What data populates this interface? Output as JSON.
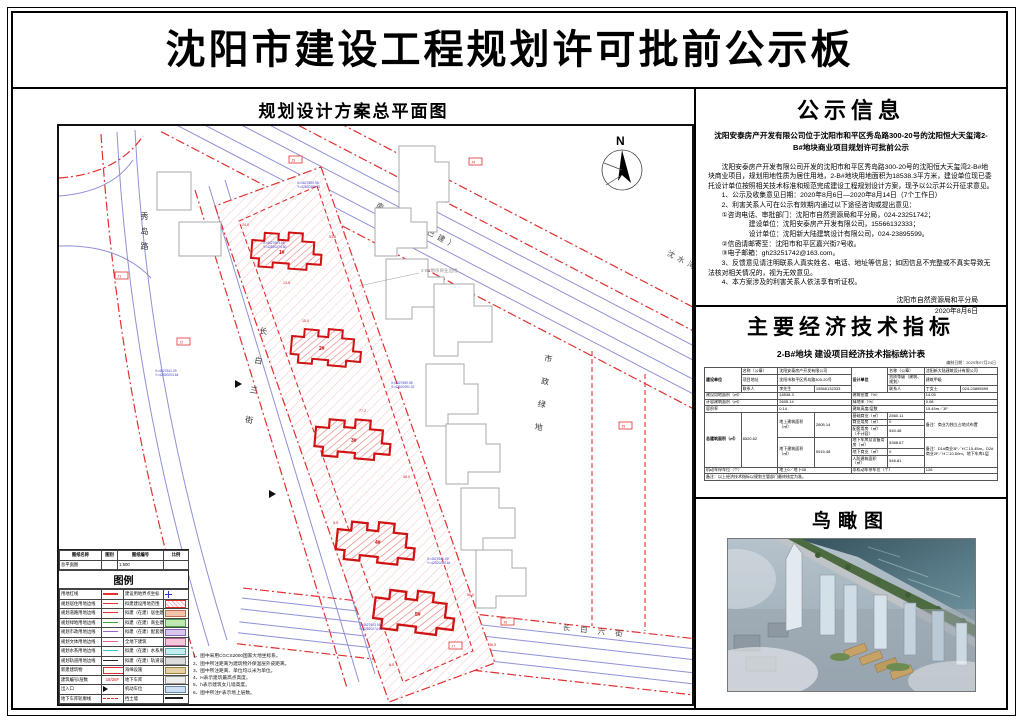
{
  "page": {
    "title": "沈阳市建设工程规划许可批前公示板"
  },
  "plan": {
    "title": "规划设计方案总平面图",
    "north": "N",
    "roads": {
      "xiudao": "秀岛路",
      "changbai3": "长白三街",
      "nandixi": "南堤西路（已建）",
      "shenshuiwan": "沈水湾路",
      "changbai6": "长 白 六 街",
      "green": "市政绿地"
    },
    "site_note": "2-B#地块商业边线",
    "buildings": [
      {
        "id": "1#"
      },
      {
        "id": "2#"
      },
      {
        "id": "3#"
      },
      {
        "id": "4#"
      },
      {
        "id": "5#"
      }
    ],
    "dims": [
      "24.0",
      "53.6",
      "13.5",
      "15.0",
      "77.2",
      "48.0",
      "9.9",
      "56.0",
      "6.0",
      "36.5"
    ],
    "coords": [
      [
        "X=4627659.98",
        "Y=42520391.02"
      ],
      [
        "X=4627603.06",
        "Y=42520274.80"
      ],
      [
        "X=4627641.09",
        "Y=42520203.64"
      ]
    ],
    "markers": [
      "J1",
      "J2",
      "J3",
      "J4",
      "J5",
      "J6",
      "J7",
      "J8"
    ],
    "legend": {
      "title": "图例",
      "head": [
        [
          {
            "t": "图纸名称",
            "cls": "b"
          },
          {
            "t": "图别",
            "cls": "b"
          },
          {
            "t": "图纸编号",
            "cls": "b"
          },
          {
            "t": "比例",
            "cls": "b"
          }
        ],
        [
          {
            "t": "总平面图"
          },
          {
            "t": ""
          },
          {
            "t": "1:500"
          },
          {
            "t": ""
          }
        ]
      ],
      "rows": [
        [
          {
            "t": "用地红线"
          },
          {
            "sym": "line-red"
          },
          {
            "t": "建设用地界点坐标"
          },
          {
            "sym": "coord"
          }
        ],
        [
          {
            "t": "规划居住用地边线"
          },
          {
            "sym": "line-red2"
          },
          {
            "t": "拟建建设用地范围"
          },
          {
            "sym": "box-redhatch"
          }
        ],
        [
          {
            "t": "规划道路用地边线"
          },
          {
            "sym": "line-red2"
          },
          {
            "t": "拟建（在建）居住建筑"
          },
          {
            "sym": "box-peach"
          }
        ],
        [
          {
            "t": "规划绿地用地边线"
          },
          {
            "sym": "line-green"
          },
          {
            "t": "拟建（在建）商业建筑"
          },
          {
            "sym": "box-green"
          }
        ],
        [
          {
            "t": "规划市政用地边线"
          },
          {
            "sym": "line-purple"
          },
          {
            "t": "拟建（在建）配套建筑"
          },
          {
            "sym": "box-purple"
          }
        ],
        [
          {
            "t": "规划文体用地边线"
          },
          {
            "sym": "line-pink"
          },
          {
            "t": "全地下建筑"
          },
          {
            "sym": "box-pink"
          }
        ],
        [
          {
            "t": "规划水系用地边线"
          },
          {
            "sym": "line-cyan"
          },
          {
            "t": "拟建（在建）水系用地"
          },
          {
            "sym": "box-cyan"
          }
        ],
        [
          {
            "t": "规划轨道用地边线"
          },
          {
            "sym": "line-black"
          },
          {
            "t": "拟建（在建）轨道设施"
          },
          {
            "sym": "box-gray"
          }
        ],
        [
          {
            "t": "新建建筑物"
          },
          {
            "sym": "box-redline"
          },
          {
            "t": "海绵设施"
          },
          {
            "sym": "box-tan"
          }
        ],
        [
          {
            "t": "建筑编号/层数"
          },
          {
            "t": "18/26F",
            "cls": "redt"
          },
          {
            "t": "地下车库"
          },
          {
            "sym": "box-lgray"
          }
        ],
        [
          {
            "t": "出入口"
          },
          {
            "sym": "arrowg"
          },
          {
            "t": "机动车位"
          },
          {
            "sym": "box-blue"
          }
        ],
        [
          {
            "t": "地下车库轮廓线"
          },
          {
            "sym": "dash-red"
          },
          {
            "t": "挡土墙"
          },
          {
            "sym": "line-black2"
          }
        ]
      ],
      "notes": [
        "1、图中采用CGCS2000国家大地坐标系。",
        "2、图中所注距离为建筑物外保温层外皮距离。",
        "3、图中所注距离、单位均以米为单位。",
        "4、H表示建筑最高点高度。",
        "5、h表示建筑女儿墙高度。",
        "6、图中所注F表示地上层数。"
      ]
    }
  },
  "notice": {
    "title": "公示信息",
    "subtitle": "沈阳安泰房产开发有限公司位于沈阳市和平区秀岛路300-20号的沈阳恒大天玺湾2-B#地块商业项目规划许可批前公示",
    "paragraphs": [
      "　　沈阳安泰房产开发有限公司开发的沈阳市和平区秀岛路300-20号的沈阳恒大天玺湾2-B#地块商业项目，规划用地性质为居住用地，2-B#地块用地面积为18538.3平方米，建设单位现已委托设计单位按照相关技术标准和规范完成建设工程规划设计方案，现予以公示并公开征求意见。",
      "　　1、公示及收集意见日期：2020年8月6日—2020年8月14日（7个工作日）",
      "　　2、利害关系人可在公示有效期内通过以下途径咨询或提出意见：",
      "　　①咨询电话、审批部门：沈阳市自然资源局和平分局，024-23251742；",
      "　　　　　　建设单位：沈阳安泰房产开发有限公司，15566132333；",
      "　　　　　　设计单位：沈阳新大陆建筑设计有限公司，024-23895599。",
      "　　②信函请邮寄至：沈阳市和平区嘉兴街7号收。",
      "　　③电子邮箱：gh23251742@163.com。",
      "　　3、反馈意见请注明联系人真实姓名、电话、地址等信息；如因信息不完整或不真实导致无法核对相关情况的，视为无效意见。",
      "　　4、本方案涉及的利害关系人依法享有听证权。"
    ],
    "sign1": "沈阳市自然资源局和平分局",
    "sign2": "2020年8月6日"
  },
  "indicators": {
    "title": "主要经济技术指标",
    "table_title": "2-B#地块 建设项目经济技术指标统计表",
    "table_date": "编制日期：2020年07月24日",
    "grid": [
      [
        {
          "t": "建设单位",
          "r": 3,
          "cls": "b"
        },
        {
          "t": "名称（公章）"
        },
        {
          "t": "沈阳安泰房产开发有限公司",
          "c": 2
        },
        {
          "t": "设计单位",
          "r": 3,
          "cls": "b"
        },
        {
          "t": "名称（公章）"
        },
        {
          "t": "沈阳新大陆建筑设计有限公司",
          "c": 2
        }
      ],
      [
        {
          "t": "项目地址"
        },
        {
          "t": "沈阳市和平区秀岛路300-20号",
          "c": 2
        },
        {
          "t": "资质等级（建筑、规划）"
        },
        {
          "t": "建筑甲级",
          "c": 2
        }
      ],
      [
        {
          "t": "联系人"
        },
        {
          "t": "李先生"
        },
        {
          "t": "15566132333"
        },
        {
          "t": "联系人"
        },
        {
          "t": "丁女士"
        },
        {
          "t": "024-23895599"
        }
      ],
      [
        {
          "t": "建设用地面积（㎡）",
          "c": 2
        },
        {
          "t": "18538.3",
          "c": 2
        },
        {
          "t": "建筑密度（%）",
          "c": 2
        },
        {
          "t": "14.05",
          "c": 2
        }
      ],
      [
        {
          "t": "计容建筑面积（㎡）",
          "c": 2
        },
        {
          "t": "2605.14",
          "c": 2
        },
        {
          "t": "绿地率（%）",
          "c": 2
        },
        {
          "t": "0.08",
          "c": 2
        }
      ],
      [
        {
          "t": "容积率",
          "c": 2
        },
        {
          "t": "0.14",
          "c": 2
        },
        {
          "t": "建筑高度/层数",
          "c": 2
        },
        {
          "t": "15.45m／3F",
          "c": 2
        }
      ],
      [
        {
          "t": "总建筑面积（㎡）",
          "r": 6,
          "cls": "b"
        },
        {
          "t": "8520.62",
          "r": 6
        },
        {
          "t": "地上建筑面积（㎡）",
          "r": 3
        },
        {
          "t": "2605.14",
          "r": 3
        },
        {
          "t": "基础商业（㎡）"
        },
        {
          "t": "2560.11"
        },
        {
          "t": "备注：商业为独立占地式布置",
          "c": 2,
          "r": 3,
          "cls": "left"
        }
      ],
      [
        {
          "t": "商业用房（㎡）"
        },
        {
          "t": "0"
        }
      ],
      [
        {
          "t": "配套用房（㎡）（不计容）"
        },
        {
          "t": "540.48"
        }
      ],
      [
        {
          "t": "地下建筑面积（㎡）",
          "r": 3
        },
        {
          "t": "5915.48",
          "r": 3
        },
        {
          "t": "地下车库及设备用房（㎡）"
        },
        {
          "t": "5368.67"
        },
        {
          "t": "备注：D1#商业3F／H＝15.45m，D2#商业2F／H＝10.50m，地下车库1层",
          "c": 2,
          "r": 3,
          "cls": "left"
        }
      ],
      [
        {
          "t": "地下商业（㎡）"
        },
        {
          "t": "0"
        }
      ],
      [
        {
          "t": "人防建筑面积（㎡）"
        },
        {
          "t": "546.81"
        }
      ],
      [
        {
          "t": "机动车停车位（个）",
          "c": 2
        },
        {
          "t": "地上0／地下58",
          "c": 2
        },
        {
          "t": "非机动车停车位（个）",
          "c": 2
        },
        {
          "t": "126",
          "c": 2
        }
      ],
      [
        {
          "t": "备注：以上经济技术指标以规划主管部门最终核定为准。",
          "c": 8,
          "cls": "left"
        }
      ]
    ]
  },
  "aerial": {
    "title": "鸟瞰图"
  }
}
